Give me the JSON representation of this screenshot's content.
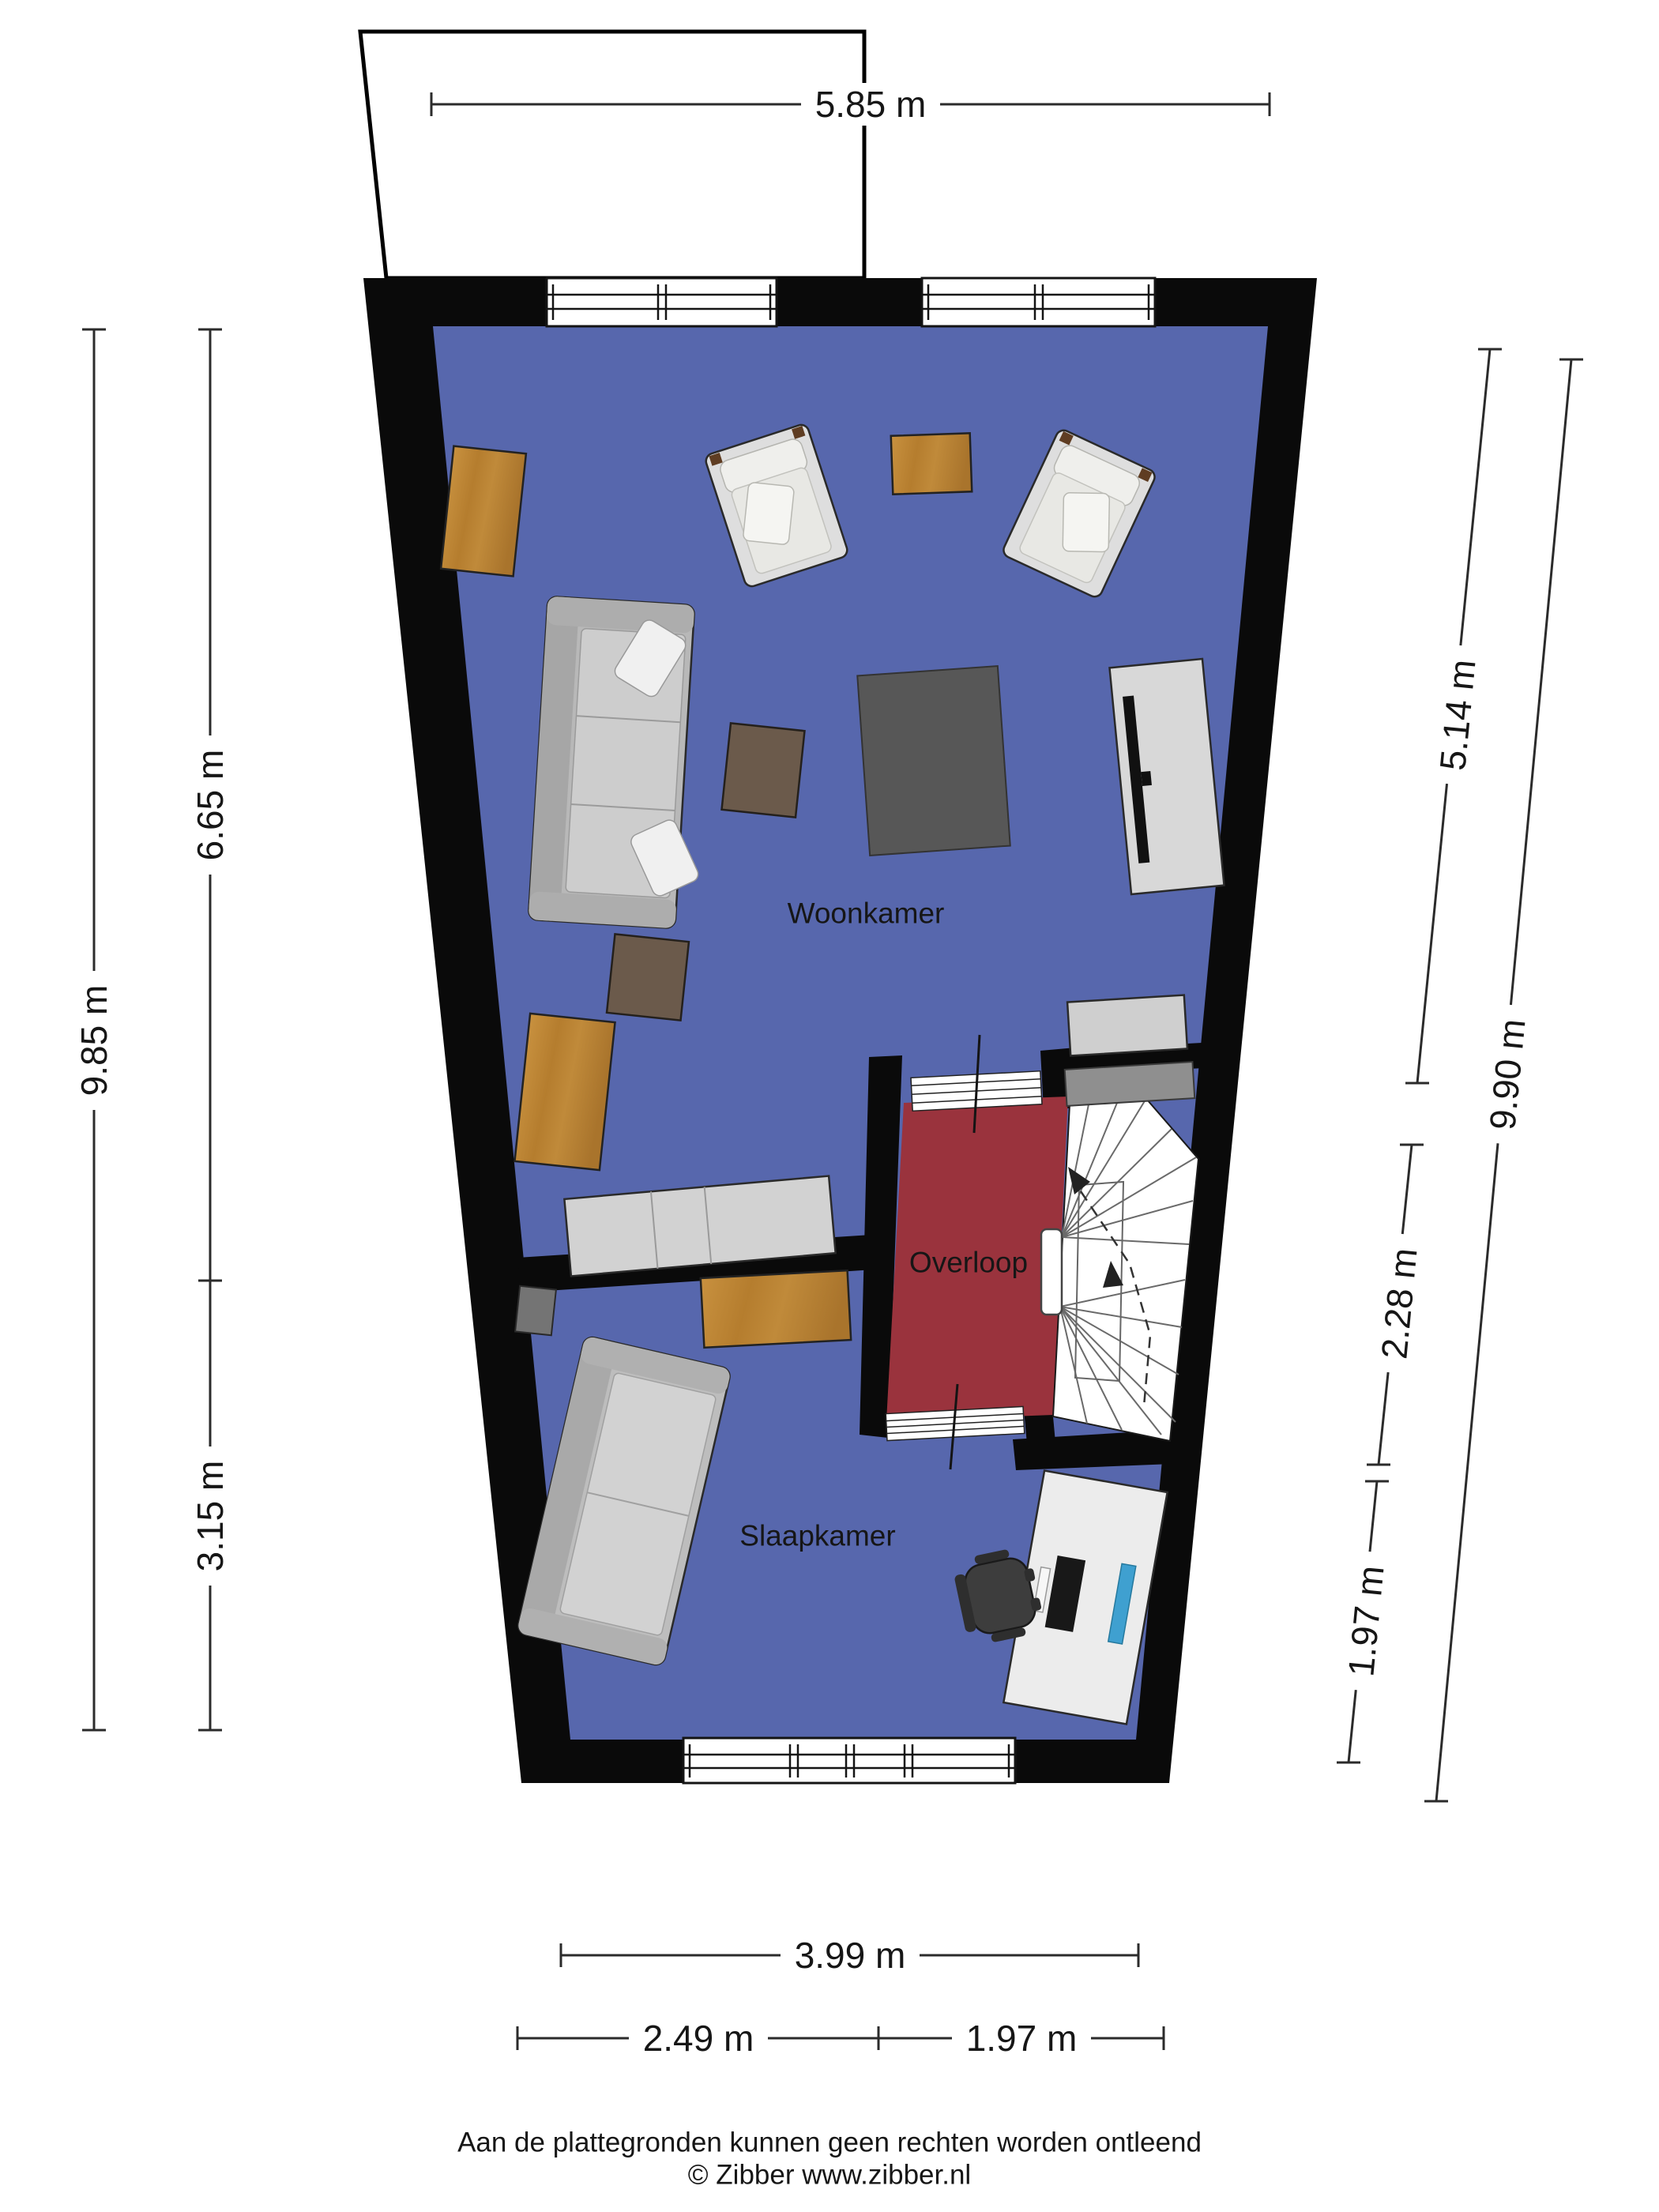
{
  "rooms": {
    "woonkamer": {
      "label": "Woonkamer"
    },
    "overloop": {
      "label": "Overloop"
    },
    "slaapkamer": {
      "label": "Slaapkamer"
    }
  },
  "dimensions": {
    "top": "5.85 m",
    "left_outer": "9.85 m",
    "left_inner_upper": "6.65 m",
    "left_inner_lower": "3.15 m",
    "right_inner_upper": "5.14 m",
    "right_inner_middle": "2.28 m",
    "right_inner_lower": "1.97 m",
    "right_outer": "9.90 m",
    "bottom_full": "3.99 m",
    "bottom_left": "2.49 m",
    "bottom_right": "1.97 m"
  },
  "footer": {
    "disclaimer": "Aan de plattegronden kunnen geen rechten worden ontleend",
    "copyright": "© Zibber www.zibber.nl"
  },
  "colors": {
    "wall": "#0a0a0a",
    "floor_main": "#5767ad",
    "floor_overloop": "#9a333d",
    "wood_light": "#bb8138",
    "wood_dark": "#6b5a4b",
    "furniture_gray": "#c9c9c9",
    "rug_gray": "#575757",
    "desk_white": "#ececec",
    "chair_dark": "#3d3d3d",
    "accent_blue_object": "#3fa0d0"
  }
}
